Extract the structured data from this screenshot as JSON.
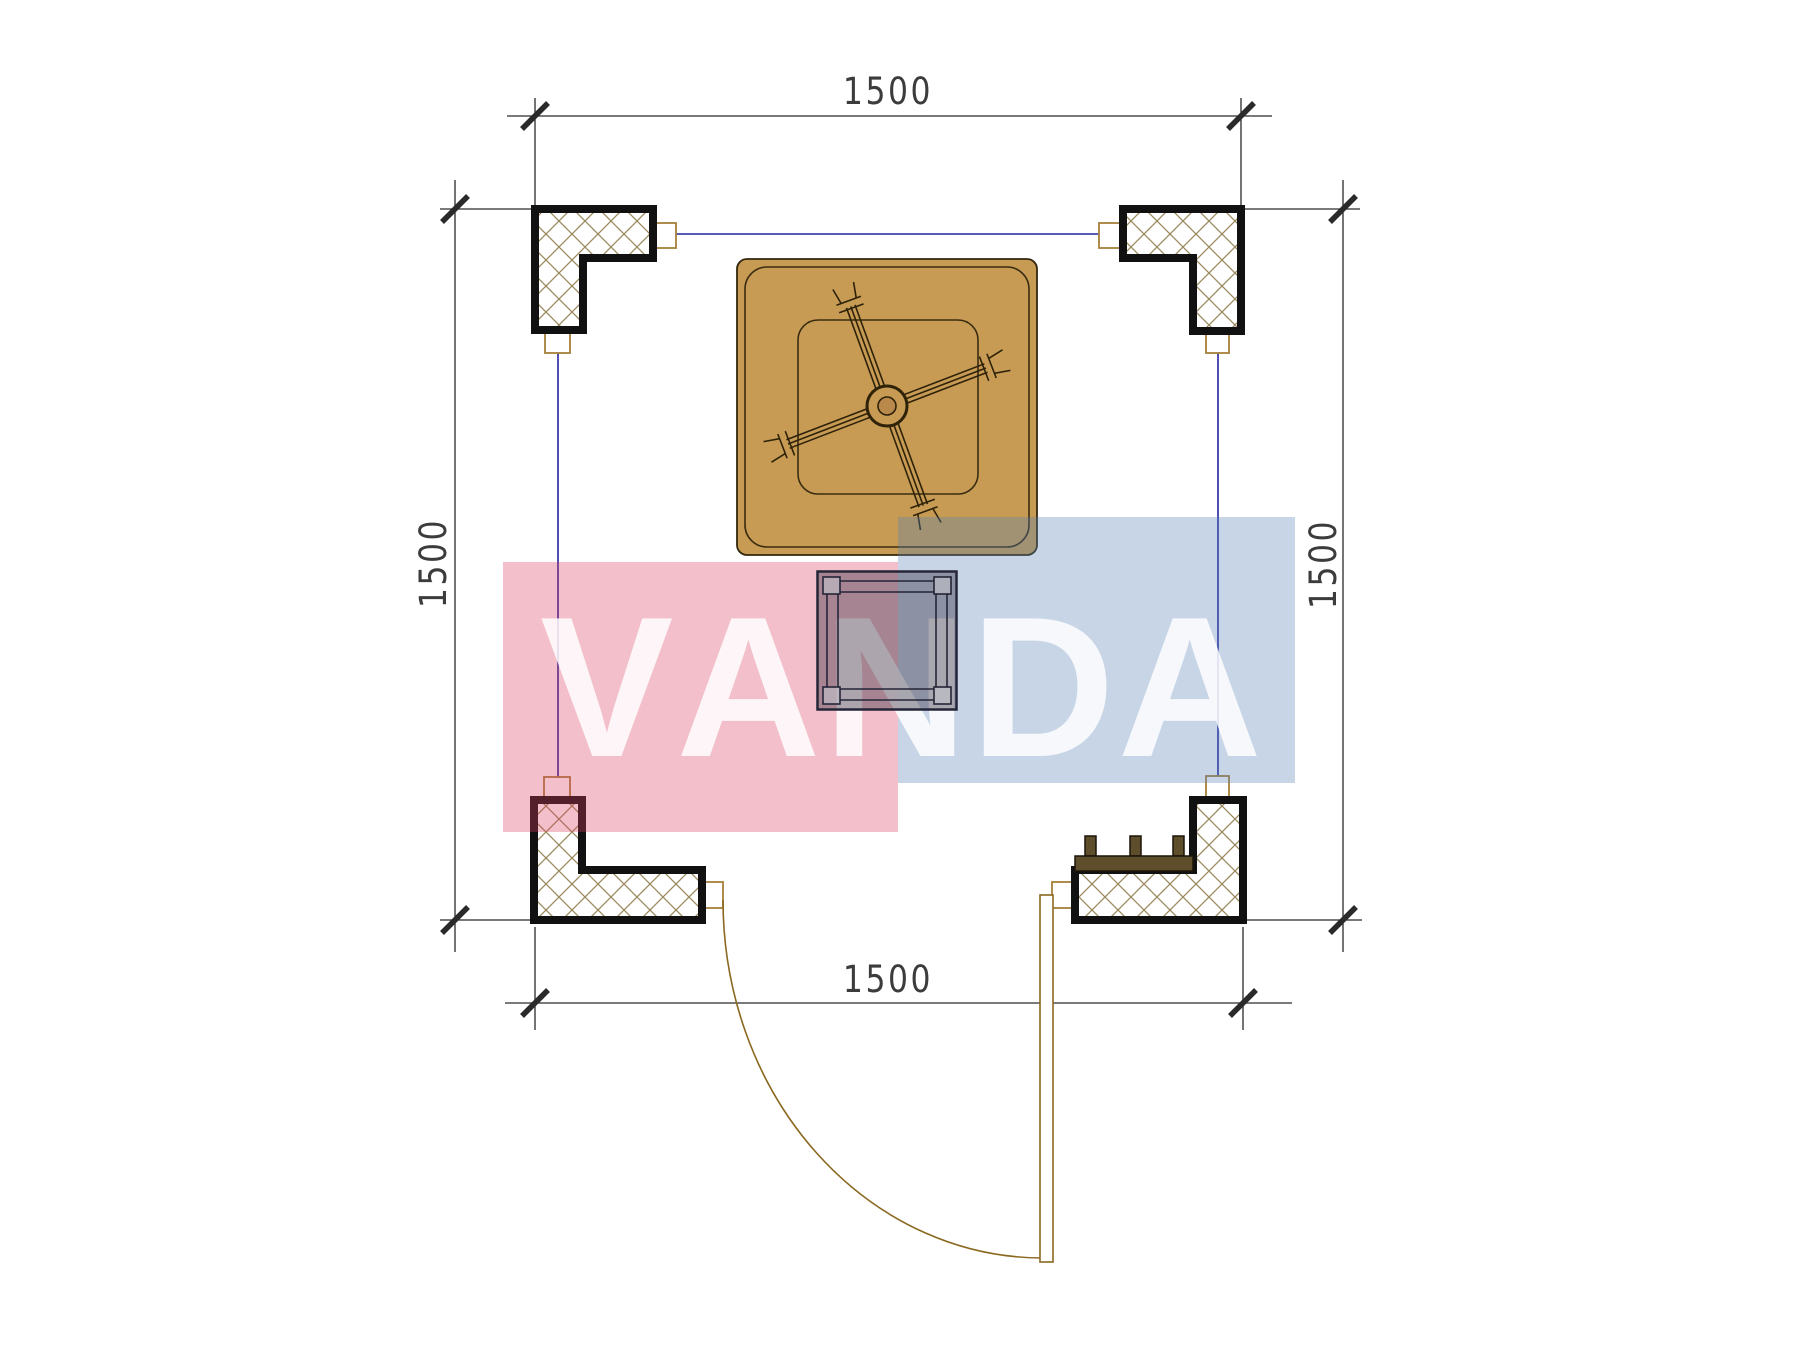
{
  "drawing": {
    "title": "square-gazebo-floor-plan",
    "dimensions": {
      "top_label": "1500",
      "bottom_label": "1500",
      "left_label": "1500",
      "right_label": "1500"
    },
    "watermark": {
      "text": "VANDA",
      "letters": [
        "V",
        "A",
        "N",
        "D",
        "A"
      ],
      "red_color": "rgba(217,62,95,0.33)",
      "blue_color": "rgba(85,127,180,0.33)",
      "text_color": "rgba(255,255,255,0.84)"
    },
    "colors": {
      "table_fill": "#C79B54",
      "table_outline": "#32270e",
      "column_outline": "#111111",
      "crosshatch_line": "#9b8a5e",
      "construction_line": "#2222a0",
      "connector_outline": "#a5803a",
      "dimension_line": "#2a2a2a",
      "bench_fill": "#5f4e2c",
      "door_line": "#8a6820",
      "stool_outline": "#252538"
    },
    "elements": [
      "corner-column-top-left",
      "corner-column-top-right",
      "corner-column-bottom-left",
      "corner-column-bottom-right",
      "square-table-with-fan",
      "stool",
      "bench",
      "door-swing",
      "dimension-top",
      "dimension-bottom",
      "dimension-left",
      "dimension-right"
    ]
  }
}
